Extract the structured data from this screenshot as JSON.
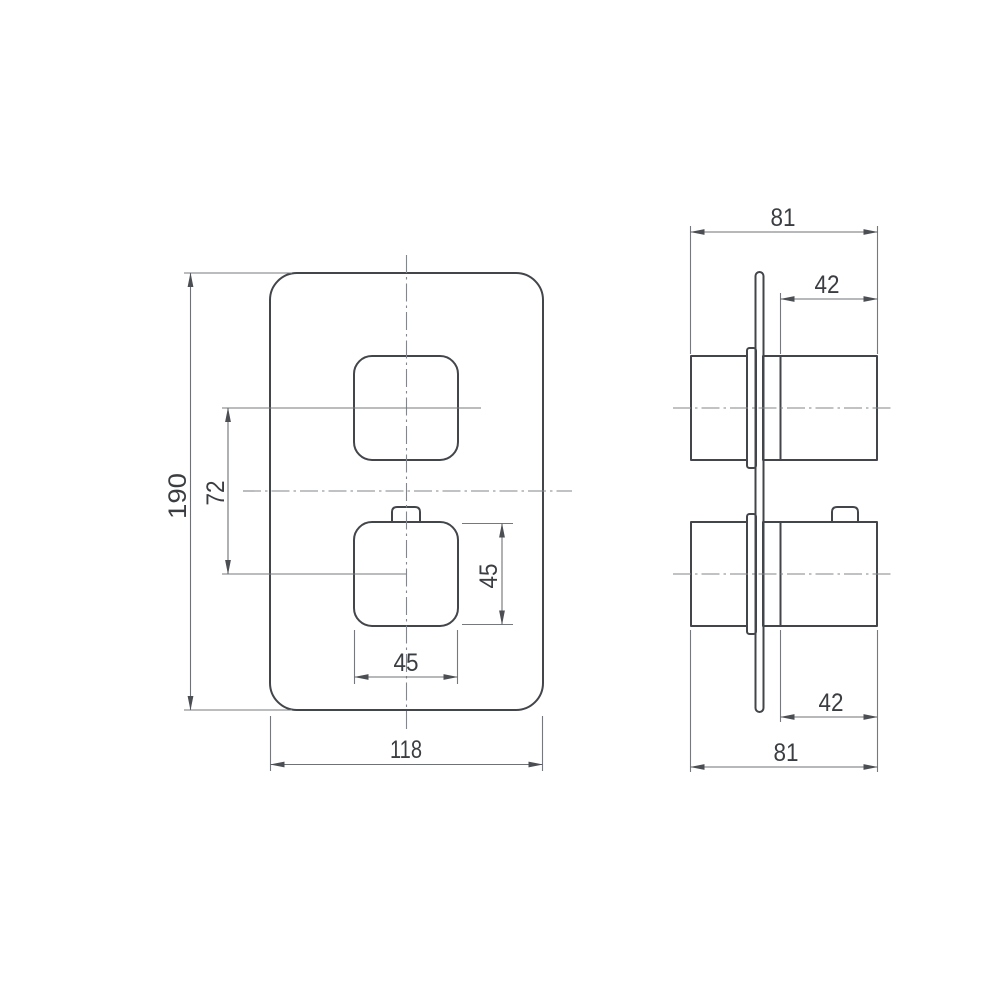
{
  "colors": {
    "background": "#ffffff",
    "object_lines": "#42454a",
    "dimension_lines": "#6e7175",
    "centerlines": "#83868a",
    "label_text": "#3a3d41"
  },
  "front_view": {
    "height_label": "190",
    "handle_spacing_label": "72",
    "handle_height_label": "45",
    "handle_width_label": "45",
    "width_label": "118"
  },
  "side_view": {
    "top_depth_label": "81",
    "top_protrusion_label": "42",
    "bottom_protrusion_label": "42",
    "bottom_depth_label": "81"
  }
}
